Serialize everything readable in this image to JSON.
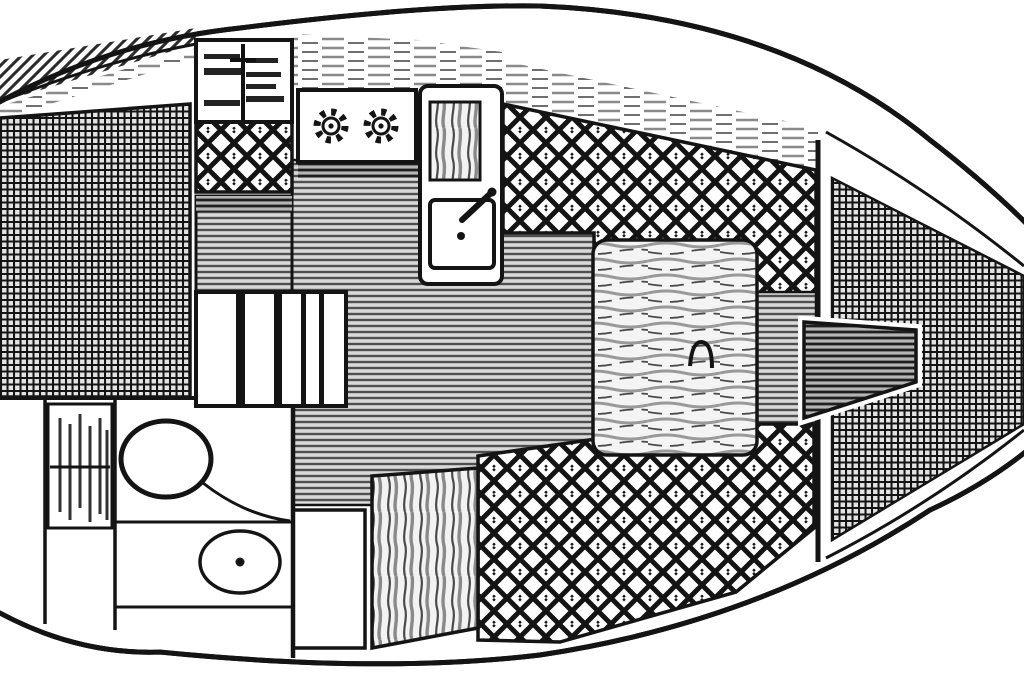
{
  "diagram": {
    "type": "floor-plan",
    "subject": "sailboat interior plan view, bow left and stern right, black-and-white line drawing",
    "colors": {
      "ink": "#141414",
      "paper": "#ffffff",
      "stripe-bg": "#d9d9d9",
      "stripe-line": "#4f4f4f",
      "grid-bg": "#e3e3e3",
      "wood-bg": "#f2f2f2",
      "wood-line": "#4a4a4a",
      "streak": "#8a8a8a"
    },
    "regions": [
      {
        "name": "bow-deck-hatching",
        "pattern": "diagonal-hatch"
      },
      {
        "name": "v-berth-cushion",
        "pattern": "fine-grid"
      },
      {
        "name": "forward-shelf-locker",
        "pattern": "shelf-bars"
      },
      {
        "name": "forward-diamond-locker",
        "pattern": "diamond-lattice"
      },
      {
        "name": "port-counter-forward",
        "pattern": "horizontal-stripes"
      },
      {
        "name": "saloon-berth-area",
        "pattern": "horizontal-stripes"
      },
      {
        "name": "folding-table-steps",
        "pattern": "white-slats"
      },
      {
        "name": "galley-stove-two-burners",
        "pattern": "white-panel"
      },
      {
        "name": "galley-sink-counter",
        "pattern": "wood-and-sink"
      },
      {
        "name": "starboard-quarter-berth",
        "pattern": "diamond-lattice"
      },
      {
        "name": "nav-table-wood-top",
        "pattern": "wood-grain-horizontal"
      },
      {
        "name": "port-quarter-berth",
        "pattern": "diamond-lattice"
      },
      {
        "name": "wet-locker-wood-panel",
        "pattern": "wood-grain-vertical"
      },
      {
        "name": "head-compartment",
        "pattern": "white-panel"
      },
      {
        "name": "head-louvered-locker",
        "pattern": "vertical-louvers"
      },
      {
        "name": "head-toilet",
        "pattern": "outline"
      },
      {
        "name": "head-wash-basin",
        "pattern": "outline"
      },
      {
        "name": "main-bulkhead",
        "pattern": "line"
      },
      {
        "name": "cockpit-sole",
        "pattern": "fine-grid"
      },
      {
        "name": "tiller-rudder-head",
        "pattern": "horizontal-stripes"
      }
    ]
  }
}
